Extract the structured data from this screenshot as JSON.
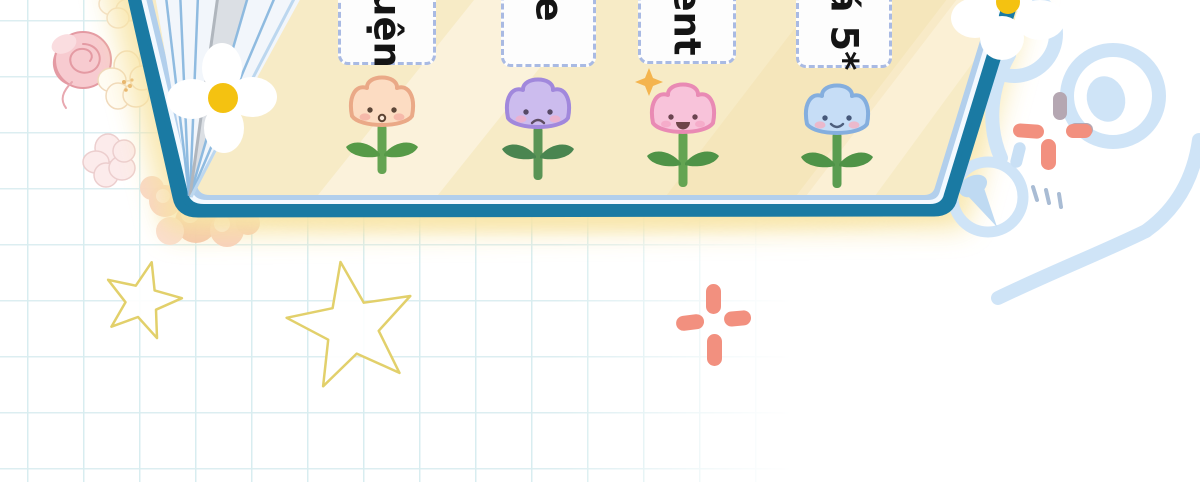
{
  "cards": [
    {
      "label": "uện"
    },
    {
      "label": "e"
    },
    {
      "label": "ent"
    },
    {
      "label": "á 5*"
    }
  ],
  "flowers": [
    {
      "name": "peach-tulip-surprised",
      "petal_color": "#fcdcc2"
    },
    {
      "name": "purple-tulip-sad",
      "petal_color": "#ccbcee"
    },
    {
      "name": "pink-tulip-happy",
      "petal_color": "#f8c3da"
    },
    {
      "name": "blue-tulip-smiling",
      "petal_color": "#c6ddf6"
    }
  ],
  "decorations": {
    "icons": [
      "daisy-icon",
      "rose-icon",
      "blossom-icon",
      "bear-outline-icon",
      "pushpin-icon",
      "sparkle-plus-icon",
      "star-outline-icon",
      "four-point-sparkle-icon"
    ],
    "star_count": 2,
    "sparkle_plus_count": 2
  },
  "colors": {
    "board_border_teal": "#1a7aa3",
    "board_inner_line_blue": "#a9c6e8",
    "board_cream": "#f7ebc6",
    "glow_yellow": "#f8e5a6",
    "card_dash": "#a9bae3",
    "grid_line": "#d8edf0",
    "coral_sparkle": "#f2907f",
    "bear_blue": "#cfe4f7",
    "star_yellow": "#e2d06b"
  }
}
